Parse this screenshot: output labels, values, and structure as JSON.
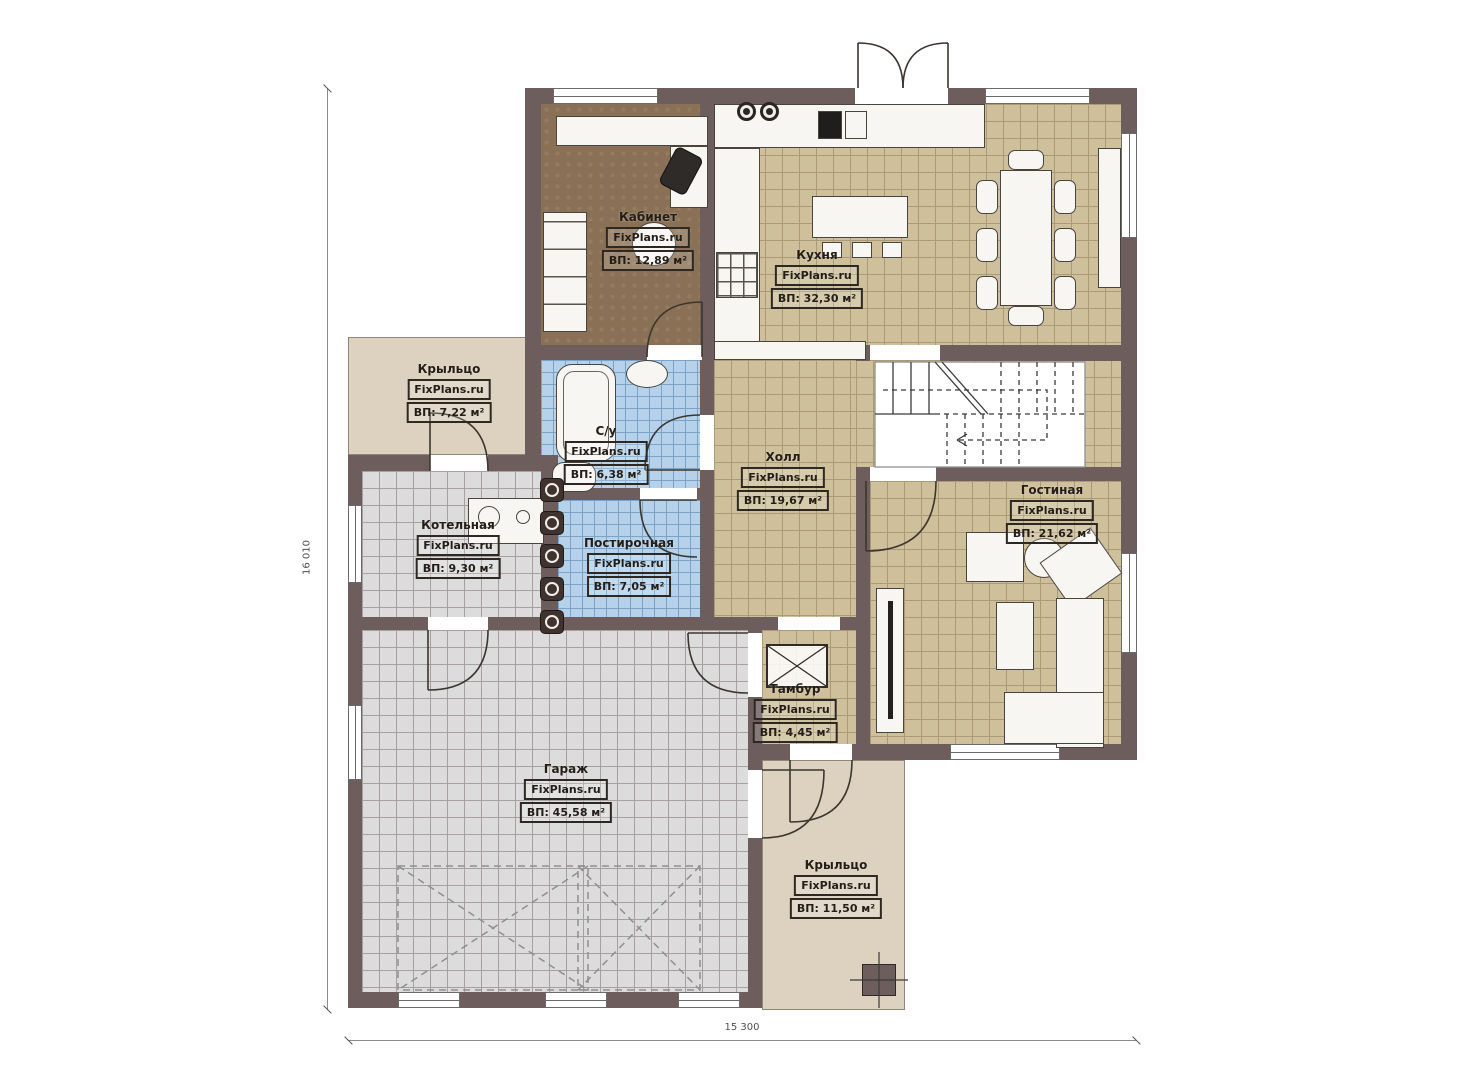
{
  "plan": {
    "brand": "FixPlans.ru",
    "rooms": {
      "kabinet": {
        "name": "Кабинет",
        "area": "ВП: 12,89 м²"
      },
      "kuhnya": {
        "name": "Кухня",
        "area": "ВП: 32,30 м²"
      },
      "kryltso_left": {
        "name": "Крыльцо",
        "area": "ВП: 7,22 м²"
      },
      "su": {
        "name": "С/у",
        "area": "ВП: 6,38 м²"
      },
      "holl": {
        "name": "Холл",
        "area": "ВП: 19,67 м²"
      },
      "gostinaya": {
        "name": "Гостиная",
        "area": "ВП: 21,62 м²"
      },
      "kotelnaya": {
        "name": "Котельная",
        "area": "ВП: 9,30 м²"
      },
      "postirochnaya": {
        "name": "Постирочная",
        "area": "ВП: 7,05 м²"
      },
      "tambur": {
        "name": "Тамбур",
        "area": "ВП: 4,45 м²"
      },
      "garazh": {
        "name": "Гараж",
        "area": "ВП: 45,58 м²"
      },
      "kryltso_bottom": {
        "name": "Крыльцо",
        "area": "ВП: 11,50 м²"
      }
    },
    "dimensions": {
      "bottom": "15 300",
      "left": "16 010"
    },
    "colors": {
      "wall": "#6e5d5d",
      "floor_tan": "#cfc09c",
      "floor_blue": "#b5d2ea",
      "floor_gray": "#dcdcdc",
      "floor_office": "#8a7156",
      "porch": "#ddd1bf"
    }
  }
}
